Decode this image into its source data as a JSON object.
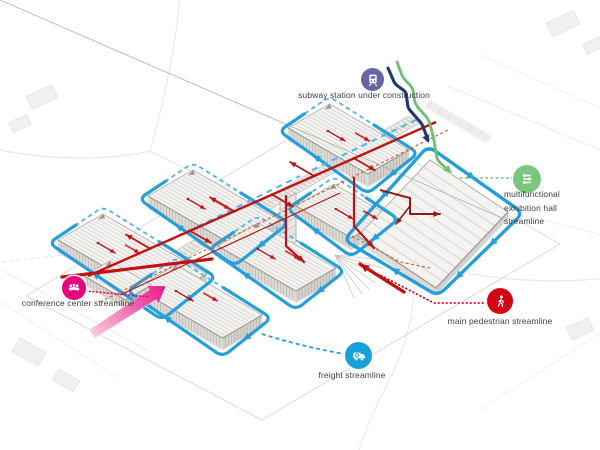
{
  "title": "exhibition complex streamline diagram",
  "legend": {
    "subway": {
      "label": "subway station under construction",
      "color": "#6766a3",
      "icon": "train-icon"
    },
    "multifunctional": {
      "label": "multifunctional exhibition hall streamline",
      "color": "#7cc77f",
      "icon": "sliders-icon"
    },
    "pedestrian": {
      "label": "main pedestrian streamline",
      "color": "#d40313",
      "icon": "walking-person-icon"
    },
    "freight": {
      "label": "freight streamline",
      "color": "#18a0dc",
      "icon": "truck-icon"
    },
    "conference": {
      "label": "conference center streamline",
      "color": "#e5067e",
      "icon": "people-icon"
    }
  },
  "colors": {
    "label_text": "#3f3f3f",
    "pedestrian_route": "#c11212",
    "pedestrian_dark": "#8e1a15",
    "freight_route": "#249fd9",
    "freight_dash": "#53b4e2",
    "subway_route": "#20386b",
    "multifunctional_route": "#6fbe72",
    "conference_route": "#e5067e",
    "service_dashed": "#c4683b",
    "building_outline": "#b3afaa",
    "building_roof": "#f4f3f1",
    "building_ridge": "#ccc9c5",
    "building_wall": "#dedbd7",
    "building_wall_hatch": "#a8a49e",
    "background_road": "#ebebeb",
    "site_outline": "#dedbd8",
    "pink_arrow_light": "#f8cade",
    "pink_arrow_dark": "#e9188a"
  }
}
